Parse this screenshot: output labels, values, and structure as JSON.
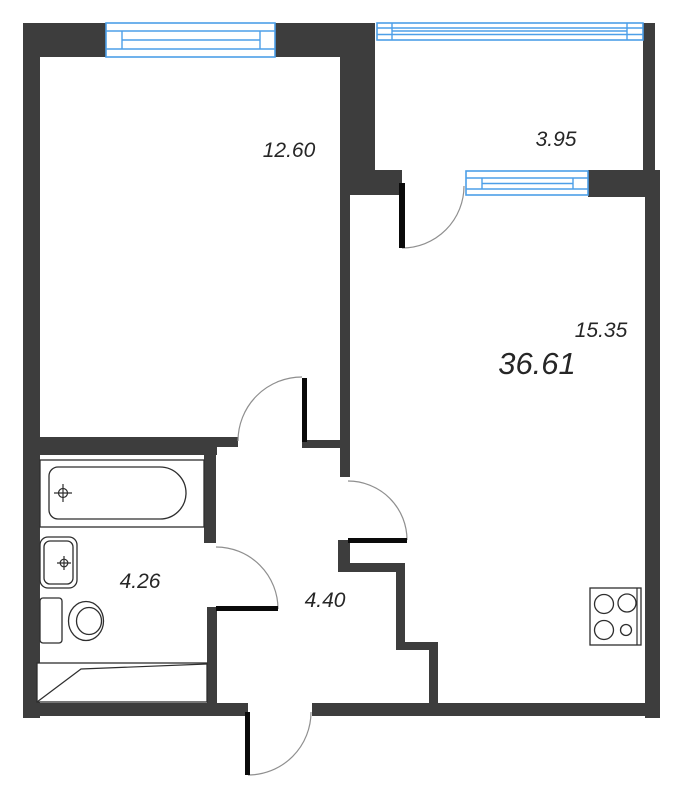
{
  "plan_title": "apartment-floor-plan",
  "rooms": [
    {
      "id": "room",
      "area_label": "12.60"
    },
    {
      "id": "balcony",
      "area_label": "3.95"
    },
    {
      "id": "kitchen-living",
      "area_label": "15.35"
    },
    {
      "id": "bathroom",
      "area_label": "4.26"
    },
    {
      "id": "hallway",
      "area_label": "4.40"
    }
  ],
  "total_area_label": "36.61",
  "fixtures": [
    {
      "id": "bathtub"
    },
    {
      "id": "sink"
    },
    {
      "id": "toilet"
    },
    {
      "id": "washing-machine-niche"
    },
    {
      "id": "stove"
    }
  ],
  "colors": {
    "wall": "#3d3d3d",
    "door_leaf": "#0a0a0a",
    "door_arc": "#8f8f8f",
    "window": "#4d9fe8",
    "fixture": "#2e2e2e",
    "label": "#262626",
    "background": "#ffffff"
  }
}
